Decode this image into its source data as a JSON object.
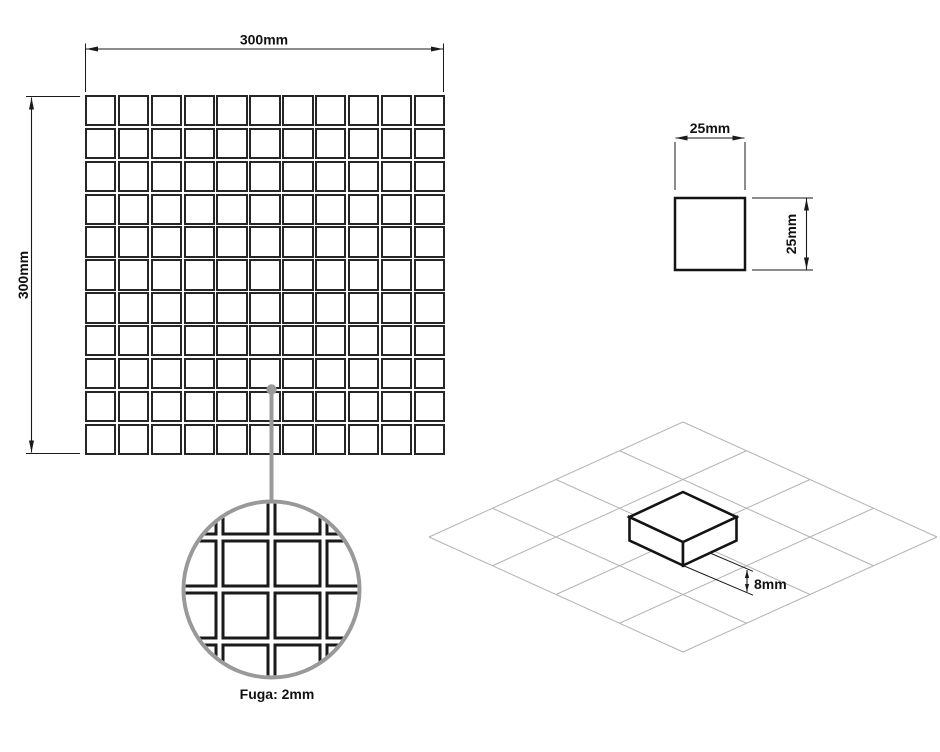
{
  "drawing": {
    "sheet": {
      "width_label": "300mm",
      "height_label": "300mm",
      "rows": 11,
      "cols": 11
    },
    "tile": {
      "width_label": "25mm",
      "height_label": "25mm"
    },
    "grout": {
      "label": "Fuga: 2mm",
      "detail_rows": 4,
      "detail_cols": 4,
      "detail_pitch": 52,
      "detail_gap": 7
    },
    "iso": {
      "thickness_label": "8mm",
      "grid_rows": 4,
      "grid_cols": 4
    },
    "colors": {
      "line": "#1a1a1a",
      "tile_border": "#262626",
      "leader": "#999999",
      "iso_grid": "#b3b3b3",
      "background": "#ffffff"
    }
  }
}
